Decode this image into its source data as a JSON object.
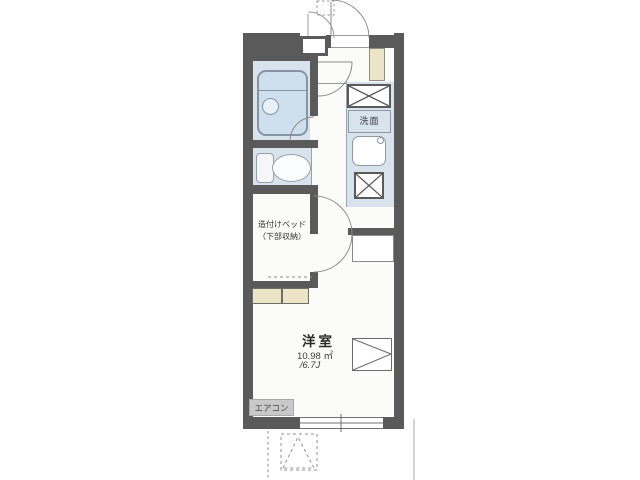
{
  "plan": {
    "type": "apartment-floor-plan",
    "labels": {
      "bed_line1": "造付けベッド",
      "bed_line2": "（下部収納）",
      "washroom": "洗面",
      "room_name": "洋室",
      "room_area_m2": "10.98 ㎡",
      "room_area_jo": "/6.7J",
      "aircon": "エアコン"
    },
    "rooms": [
      {
        "name": "洋室",
        "area_m2": "10.98 ㎡",
        "area_jo": "6.7J"
      },
      {
        "name": "洗面"
      }
    ],
    "fixtures": [
      "bathtub",
      "toilet",
      "washing-machine-space",
      "washbasin-sink",
      "stove",
      "shoe-cabinet",
      "built-in-bed-storage",
      "bed-foot-shelf",
      "refrigerator-space",
      "air-conditioner",
      "entrance-door",
      "room-door",
      "bathroom-door",
      "window"
    ]
  },
  "colors": {
    "wall": "#5a5a5a",
    "wet": "#d9e3ed",
    "tub": "#cfdfee",
    "cabinet": "#ece4c6",
    "aircon_bg": "#c9c9c9",
    "line": "#8a8a8a"
  },
  "icons": {
    "bathtub": "rounded-rect-with-drain-circle",
    "toilet": "tank-and-bowl",
    "washing-machine-space": "box-with-x",
    "stove": "box-with-x",
    "washbasin-sink": "rounded-square-with-faucet-dot",
    "refrigerator-space": "box-with-converging-diagonals",
    "door": "quarter-arc-swing",
    "window": "double-line-in-wall"
  }
}
